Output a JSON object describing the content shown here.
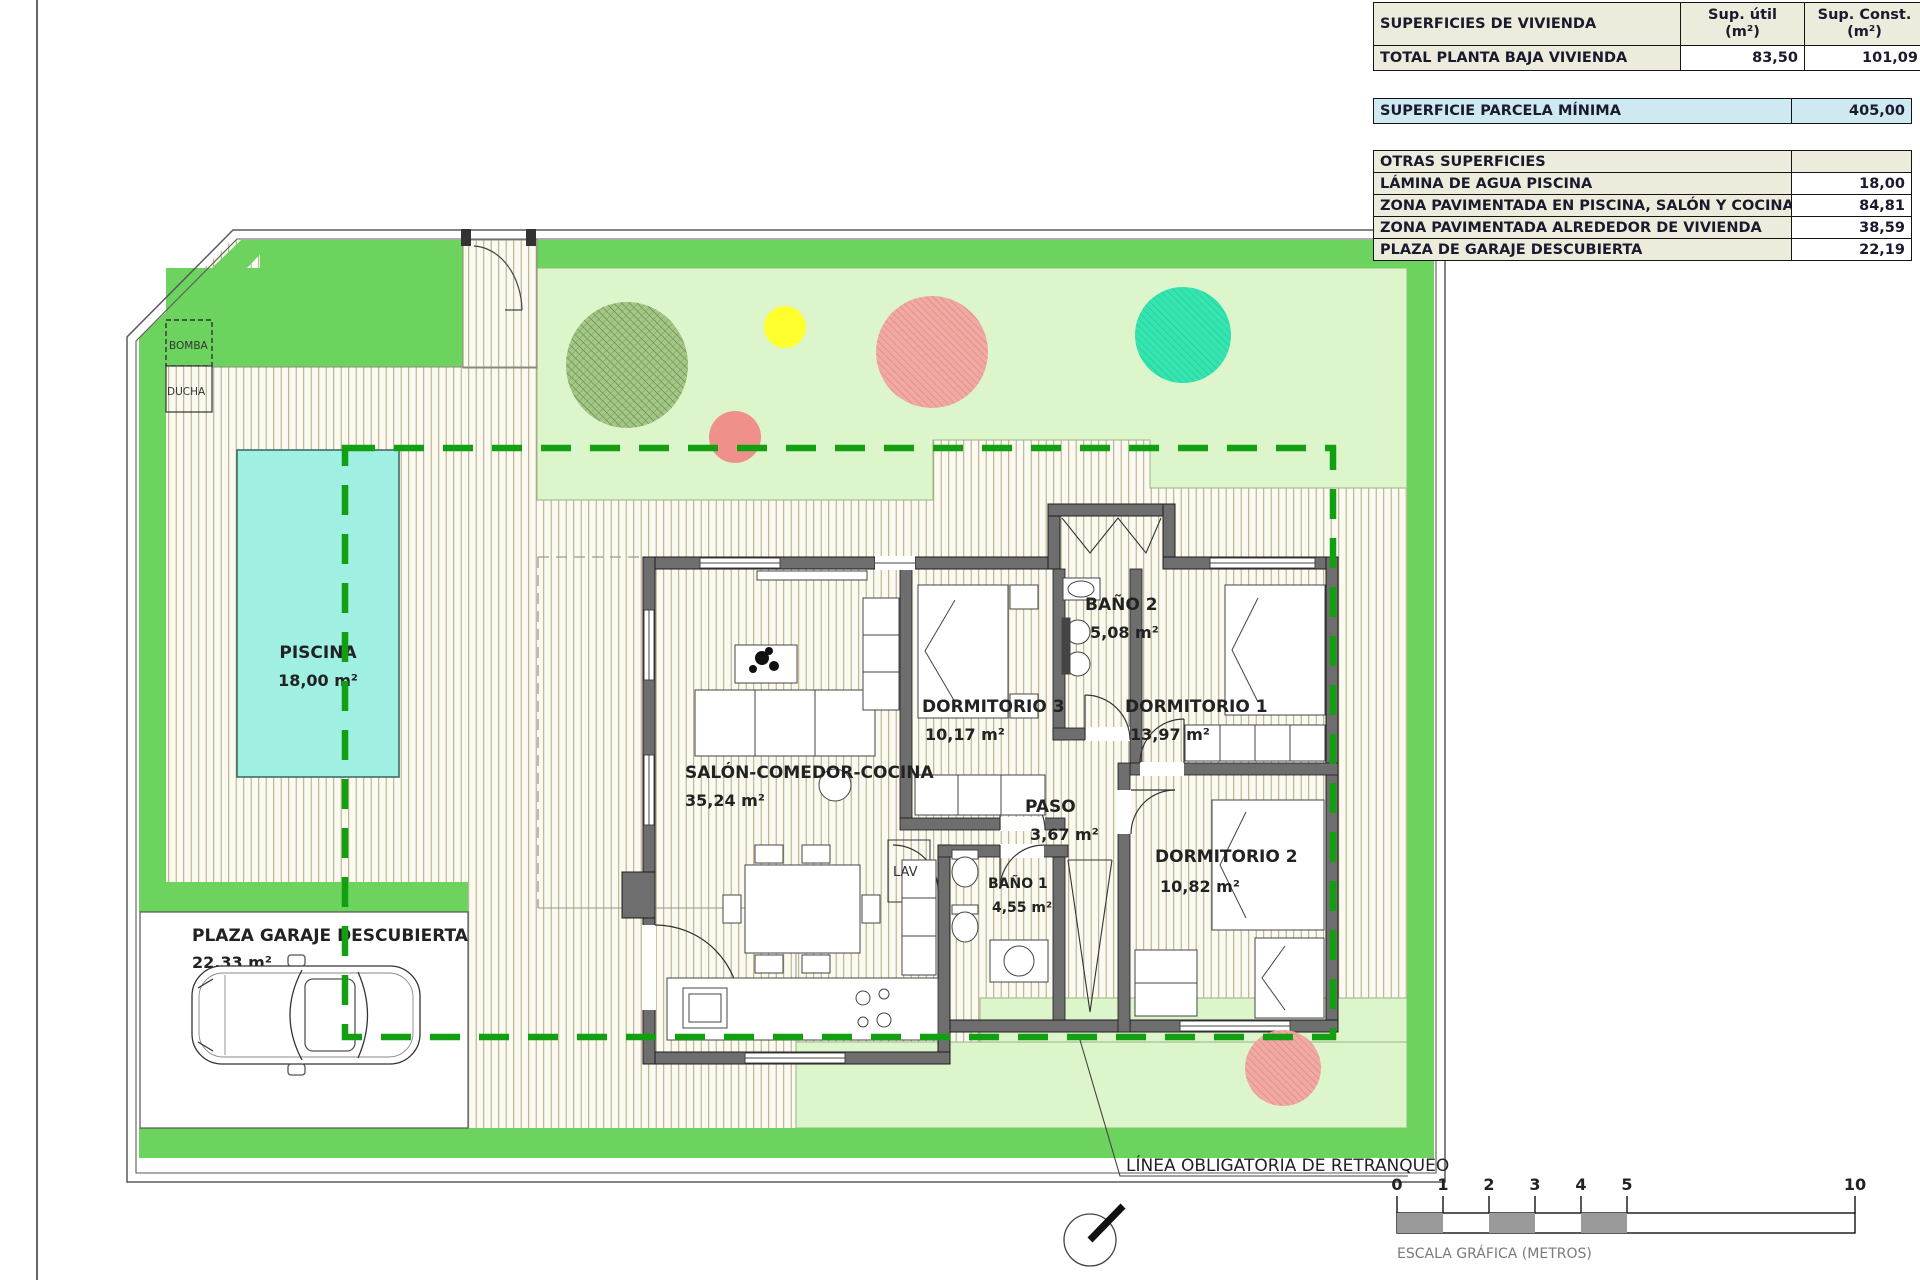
{
  "title": "Plano de planta / parcela vivienda unifamiliar",
  "table": {
    "header": {
      "label": "SUPERFICIES DE VIVIENDA",
      "col_util": "Sup. útil\n(m²)",
      "col_const": "Sup. Const.\n(m²)"
    },
    "total_row": {
      "label": "TOTAL PLANTA BAJA VIVIENDA",
      "util": "83,50",
      "const": "101,09"
    },
    "parcela_row": {
      "label": "SUPERFICIE PARCELA MÍNIMA",
      "value": "405,00"
    },
    "otras_title": "OTRAS SUPERFICIES",
    "otras": [
      {
        "label": "LÁMINA DE AGUA PISCINA",
        "value": "18,00"
      },
      {
        "label": "ZONA PAVIMENTADA EN PISCINA, SALÓN Y COCINA",
        "value": "84,81"
      },
      {
        "label": "ZONA PAVIMENTADA ALREDEDOR DE VIVIENDA",
        "value": "38,59"
      },
      {
        "label": "PLAZA DE GARAJE DESCUBIERTA",
        "value": "22,19"
      }
    ]
  },
  "rooms": {
    "piscina": {
      "name": "PISCINA",
      "area": "18,00 m²"
    },
    "salon": {
      "name": "SALÓN-COMEDOR-COCINA",
      "area": "35,24 m²"
    },
    "dormitorio3": {
      "name": "DORMITORIO 3",
      "area": "10,17 m²"
    },
    "bano2": {
      "name": "BAÑO 2",
      "area": "5,08 m²"
    },
    "dormitorio1": {
      "name": "DORMITORIO 1",
      "area": "13,97 m²"
    },
    "paso": {
      "name": "PASO",
      "area": "3,67 m²"
    },
    "bano1": {
      "name": "BAÑO 1",
      "area": "4,55 m²"
    },
    "dormitorio2": {
      "name": "DORMITORIO 2",
      "area": "10,82 m²"
    },
    "plaza": {
      "name": "PLAZA GARAJE DESCUBIERTA",
      "area": "22,33 m²"
    },
    "lav": "LAV",
    "bomba": "BOMBA",
    "ducha": "DUCHA"
  },
  "annotations": {
    "retranqueo": "LÍNEA OBLIGATORIA DE RETRANQUEO",
    "escala": "ESCALA GRÁFICA (METROS)"
  },
  "scale": {
    "ticks": [
      "0",
      "1",
      "2",
      "3",
      "4",
      "5",
      "10"
    ]
  },
  "colors": {
    "beige": "#edecdc",
    "blue": "#cfe9f2",
    "green-band": "#6dd35f",
    "dash-green": "#12a012",
    "garden": "#ddf5cb",
    "pool": "#9fefe2",
    "wall": "#6e6e6e",
    "hatch-bg": "#fbfaf0",
    "hatch-line": "#b3a685",
    "tree-olive": "#a4c686",
    "tree-salmon": "#f0a29c",
    "tree-teal": "#35e4ae",
    "tree-yellow": "#ffff2e",
    "circle-salmon": "#ef908b"
  }
}
